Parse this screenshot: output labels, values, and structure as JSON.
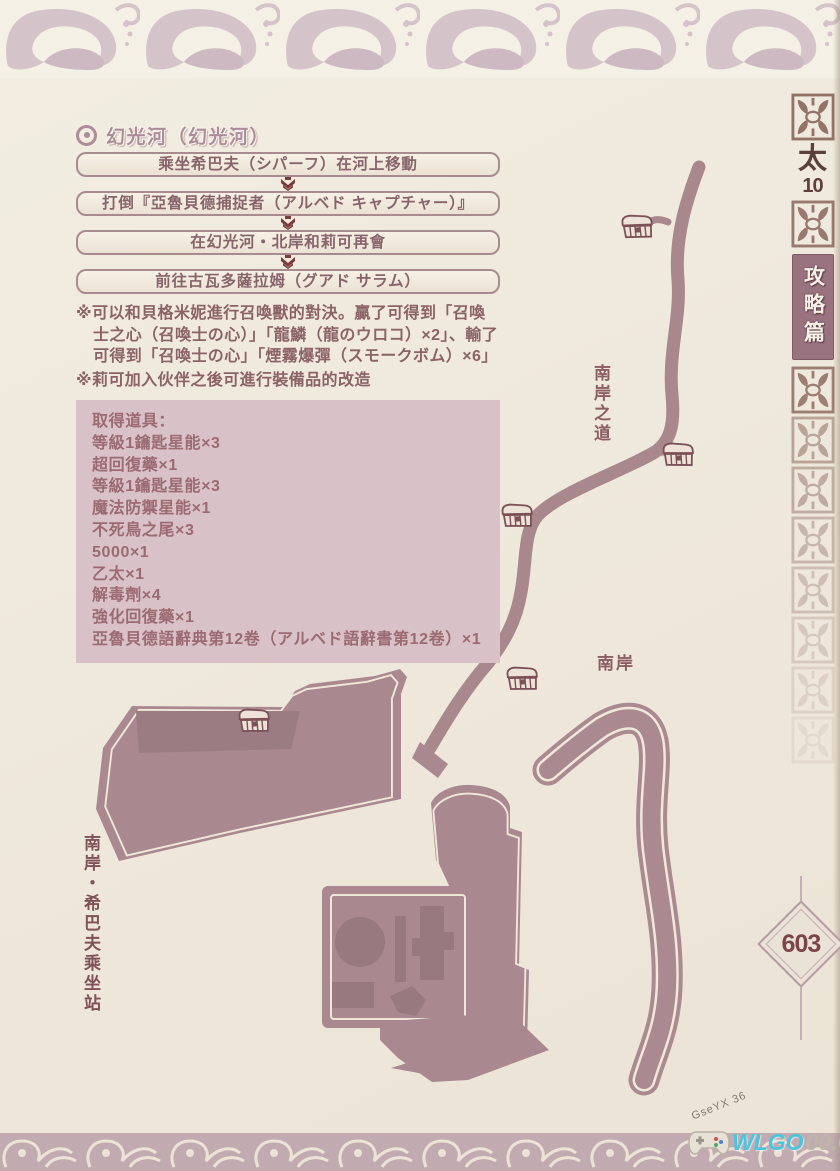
{
  "title": "幻光河（幻光河）",
  "flow_steps": [
    "乘坐希巴夫（シパーフ）在河上移動",
    "打倒『亞魯貝德捕捉者（アルベド キャプチャー）』",
    "在幻光河・北岸和莉可再會",
    "前往古瓦多薩拉姆（グアド サラム）"
  ],
  "notes": [
    "※可以和貝格米妮進行召喚獸的對決。贏了可得到「召喚士之心（召喚士の心）」「龍鱗（龍のウロコ）×2」、輸了可得到「召喚士の心」「煙霧爆彈（スモークボム）×6」",
    "※莉可加入伙伴之後可進行裝備品的改造"
  ],
  "items_box": {
    "title": "取得道具：",
    "items": [
      "等級1鑰匙星能×3",
      "超回復藥×1",
      "等級1鑰匙星能×3",
      "魔法防禦星能×1",
      "不死鳥之尾×3",
      "5000×1",
      "乙太×1",
      "解毒劑×4",
      "強化回復藥×1",
      "亞魯貝德語辭典第12卷（アルベド語辭書第12卷）×1"
    ]
  },
  "map_labels": {
    "south_road": "南岸之道",
    "south_bank": "南岸",
    "south_station": "南岸・希巴夫乘坐站"
  },
  "sidebar": {
    "series": "太",
    "number": "10",
    "section": "攻略篇"
  },
  "page_number": "603",
  "watermark": {
    "scribble": "GseYX 36",
    "brand_highlight": "WLGO",
    "brand_rest": "00.COM"
  },
  "colors": {
    "map_mauve": "#a9898f",
    "arrow_red": "#7a3b3c",
    "items_box_bg": "#d8c2c7",
    "watermark_cyan": "#4cc4dc",
    "sidebar_brown": "#8f6c64"
  }
}
